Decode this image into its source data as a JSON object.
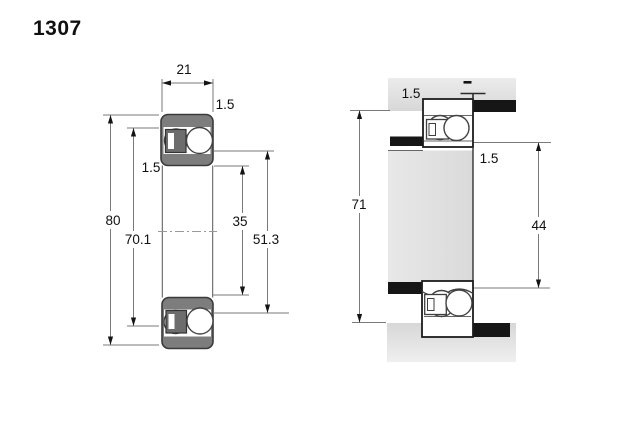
{
  "title": "1307",
  "left_view": {
    "label": "bearing cross-section view",
    "dims": {
      "width": "21",
      "outer_ring_chamfer": "1.5",
      "inner_ring_chamfer": "1.5",
      "outer_diameter": "80",
      "outer_raceway_diameter": "70.1",
      "bore_diameter": "35",
      "inner_shoulder_diameter": "51.3"
    }
  },
  "right_view": {
    "label": "mounted arrangement view",
    "dims": {
      "housing_fillet_radius": "1.5",
      "shaft_fillet_radius": "1.5",
      "housing_abutment_diameter": "71",
      "shaft_abutment_diameter": "44"
    }
  },
  "colors": {
    "ring_fill": "#7d7d7d",
    "cage_fill": "#6d6d6d",
    "housing_fill": "#e3e3e3",
    "shoulder_fill": "#161616",
    "outline": "#3a3a3a",
    "dim_line": "#7a7a7a",
    "arrow": "#141414",
    "text": "#101010",
    "background": "#ffffff"
  }
}
